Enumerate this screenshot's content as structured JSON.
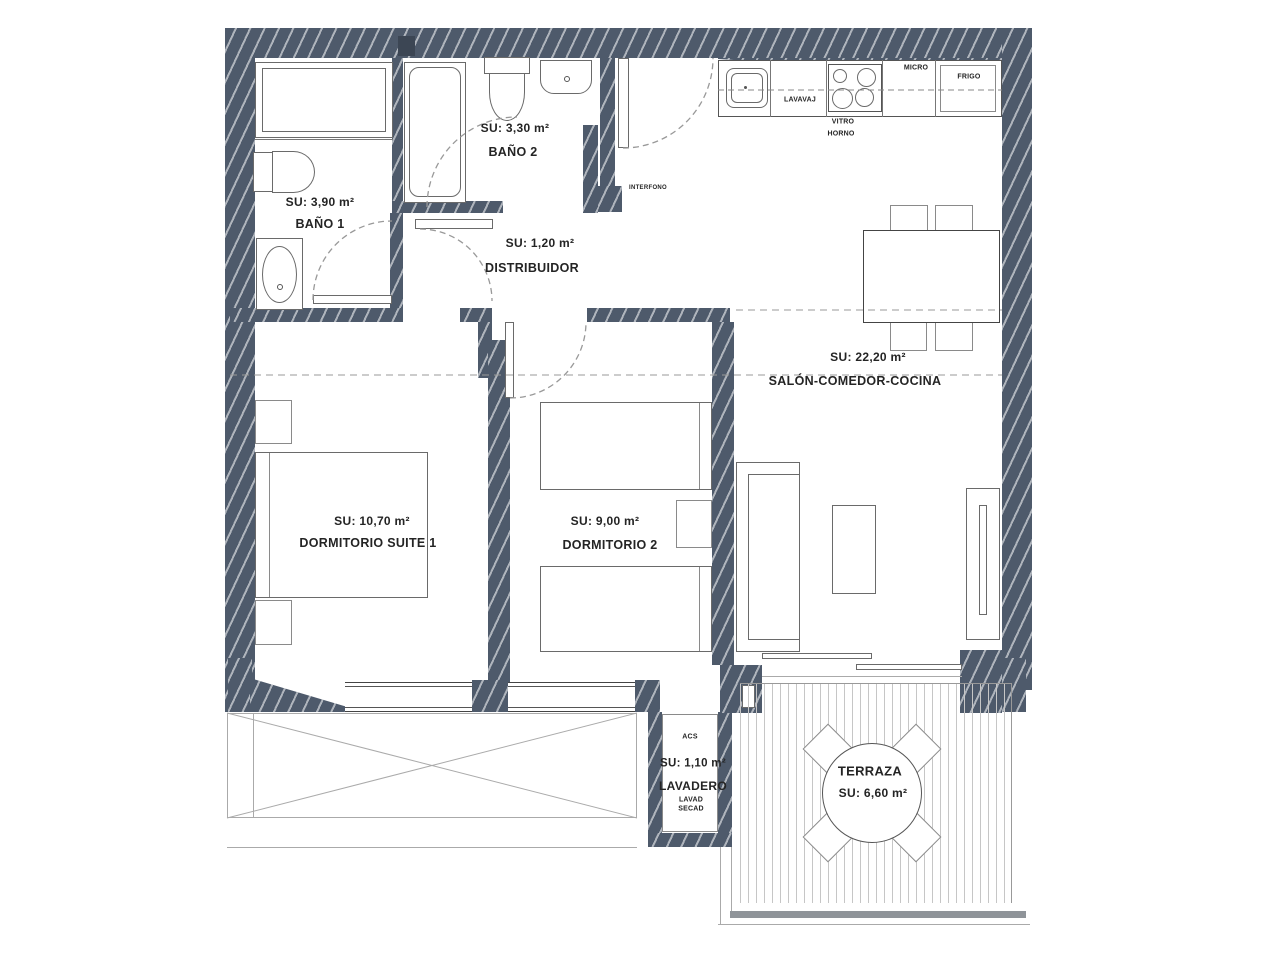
{
  "plan": {
    "rooms": {
      "banyo1": {
        "name": "BAÑO 1",
        "su": "SU: 3,90 m²"
      },
      "banyo2": {
        "name": "BAÑO 2",
        "su": "SU: 3,30 m²"
      },
      "distribuidor": {
        "name": "DISTRIBUIDOR",
        "su": "SU: 1,20 m²"
      },
      "salon": {
        "name": "SALÓN-COMEDOR-COCINA",
        "su": "SU: 22,20 m²"
      },
      "dorm1": {
        "name": "DORMITORIO SUITE 1",
        "su": "SU: 10,70 m²"
      },
      "dorm2": {
        "name": "DORMITORIO 2",
        "su": "SU: 9,00 m²"
      },
      "lavadero": {
        "name": "LAVADERO",
        "su": "SU: 1,10 m²",
        "acs": "ACS",
        "lavad": "LAVAD",
        "secad": "SECAD"
      },
      "terraza": {
        "name": "TERRAZA",
        "su": "SU: 6,60 m²"
      }
    },
    "kitchen": {
      "lavavaj": "LAVAVAJ",
      "vitro": "VITRO",
      "horno": "HORNO",
      "micro": "MICRO",
      "frigo": "FRIGO"
    },
    "entry": {
      "interfono": "INTERFONO"
    },
    "colors": {
      "wall": "#4e5a6b",
      "line": "#555555",
      "dash": "#999999"
    }
  }
}
